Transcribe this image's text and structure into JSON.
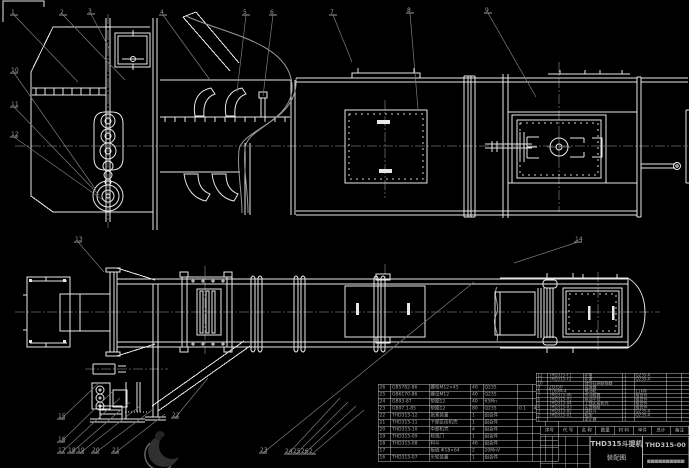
{
  "colors": {
    "background": "#000000",
    "drawing_line": "#e8e8e8",
    "leader_line": "#7d7d7d",
    "table_line": "#c4c4c4",
    "table_text": "#a8a8a8"
  },
  "title_block": {
    "product": "THD315斗提机",
    "subtitle": "装配图",
    "drawing_no": "THD315-00",
    "footer": "■■■■■■■■■■"
  },
  "bom": {
    "header": [
      "序号",
      "代  号",
      "名  称",
      "数量",
      "材  料",
      "单件",
      "总计",
      "备注"
    ],
    "left": {
      "rows": [
        [
          "26",
          "GB5782-86",
          "螺栓M12×45",
          "40",
          "Q235",
          "",
          "",
          ""
        ],
        [
          "25",
          "GB6170-86",
          "螺母M12",
          "40",
          "Q235",
          "",
          "",
          ""
        ],
        [
          "24",
          "GB93-87",
          "垫圈12",
          "40",
          "65Mn",
          "",
          "",
          ""
        ],
        [
          "23",
          "GB97.1-85",
          "垫圈12",
          "80",
          "Q235",
          "0.1",
          "4",
          ""
        ],
        [
          "22",
          "THD315-12",
          "张紧装置",
          "1",
          "组合件",
          "",
          "",
          ""
        ],
        [
          "21",
          "THD315-11",
          "下部区段机壳",
          "1",
          "组合件",
          "",
          "",
          ""
        ],
        [
          "20",
          "THD315-10",
          "中部机壳",
          "4",
          "组合件",
          "",
          "",
          ""
        ],
        [
          "19",
          "THD315-09",
          "检视门",
          "1",
          "组合件",
          "",
          "",
          ""
        ],
        [
          "18",
          "THD315-08",
          "料斗",
          "46",
          "组合件",
          "",
          "",
          ""
        ],
        [
          "17",
          "",
          "板链 Φ18×64",
          "2",
          "20MnV",
          "",
          "",
          ""
        ],
        [
          "16",
          "THD315-07",
          "头轮装置",
          "1",
          "组合件",
          "",
          "",
          ""
        ]
      ]
    },
    "right": {
      "rows": [
        [
          "12",
          "THD315-F1",
          "护罩",
          "1",
          "Q235-A",
          "",
          "",
          ""
        ],
        [
          "11",
          "THD315-F2",
          "护罩",
          "1",
          "Q235-A",
          "",
          "",
          ""
        ],
        [
          "10",
          "",
          "弹性柱销联轴器",
          "1",
          "",
          "",
          "",
          ""
        ],
        [
          "9",
          "ZQ350",
          "减速器",
          "1",
          "",
          "",
          "",
          ""
        ],
        [
          "8",
          "Y160M-4",
          "电动机",
          "1",
          "11kW",
          "",
          "",
          ""
        ],
        [
          "7",
          "THD315-06",
          "传动装置",
          "1",
          "组合件",
          "",
          "",
          ""
        ],
        [
          "6",
          "THD315-05",
          "驱动平台",
          "1",
          "组合件",
          "",
          "",
          ""
        ],
        [
          "5",
          "THD315-04",
          "上部区段机壳",
          "1",
          "组合件",
          "",
          "",
          ""
        ],
        [
          "4",
          "THD315-03",
          "头部轴组",
          "1",
          "组合件",
          "",
          "",
          ""
        ],
        [
          "3",
          "THD315-02",
          "进料斗",
          "1",
          "Q235-A",
          "",
          "",
          ""
        ],
        [
          "2",
          "THD315-01",
          "机架",
          "1",
          "Q235-A",
          "",
          "",
          ""
        ],
        [
          "1",
          "",
          "逆止器",
          "1",
          "",
          "",
          "",
          ""
        ]
      ]
    }
  },
  "callouts": [
    {
      "n": "1",
      "x": 11,
      "y": 8,
      "tx": 78,
      "ty": 82
    },
    {
      "n": "2",
      "x": 60,
      "y": 8,
      "tx": 125,
      "ty": 80
    },
    {
      "n": "3",
      "x": 88,
      "y": 7,
      "tx": 109,
      "ty": 48
    },
    {
      "n": "4",
      "x": 160,
      "y": 8,
      "tx": 210,
      "ty": 80
    },
    {
      "n": "5",
      "x": 243,
      "y": 8,
      "tx": 237,
      "ty": 92
    },
    {
      "n": "6",
      "x": 270,
      "y": 8,
      "tx": 263,
      "ty": 96
    },
    {
      "n": "7",
      "x": 330,
      "y": 8,
      "tx": 352,
      "ty": 62
    },
    {
      "n": "8",
      "x": 407,
      "y": 6,
      "tx": 418,
      "ty": 109
    },
    {
      "n": "9",
      "x": 485,
      "y": 6,
      "tx": 536,
      "ty": 97
    },
    {
      "n": "10",
      "x": 11,
      "y": 66,
      "tx": 96,
      "ty": 190
    },
    {
      "n": "11",
      "x": 11,
      "y": 100,
      "tx": 99,
      "ty": 195
    },
    {
      "n": "12",
      "x": 11,
      "y": 130,
      "tx": 103,
      "ty": 200
    },
    {
      "n": "13",
      "x": 75,
      "y": 235,
      "tx": 104,
      "ty": 272
    },
    {
      "n": "14",
      "x": 575,
      "y": 235,
      "tx": 514,
      "ty": 263
    },
    {
      "n": "15",
      "x": 58,
      "y": 412,
      "tx": 100,
      "ty": 382
    },
    {
      "n": "16",
      "x": 58,
      "y": 435,
      "tx": 112,
      "ty": 392
    },
    {
      "n": "17",
      "x": 58,
      "y": 446,
      "tx": 120,
      "ty": 398
    },
    {
      "n": "18",
      "x": 68,
      "y": 446,
      "tx": 130,
      "ty": 402
    },
    {
      "n": "19",
      "x": 77,
      "y": 446,
      "tx": 140,
      "ty": 406
    },
    {
      "n": "20",
      "x": 92,
      "y": 446,
      "tx": 152,
      "ty": 410
    },
    {
      "n": "21",
      "x": 112,
      "y": 446,
      "tx": 165,
      "ty": 414
    },
    {
      "n": "22",
      "x": 172,
      "y": 411,
      "tx": 208,
      "ty": 378
    },
    {
      "n": "23",
      "x": 260,
      "y": 446,
      "tx": 474,
      "ty": 282
    },
    {
      "n": "24",
      "x": 285,
      "y": 447,
      "tx": 340,
      "ty": 398
    },
    {
      "n": "25",
      "x": 293,
      "y": 447,
      "tx": 348,
      "ty": 402
    },
    {
      "n": "26",
      "x": 301,
      "y": 447,
      "tx": 356,
      "ty": 406
    },
    {
      "n": "2",
      "x": 309,
      "y": 447,
      "tx": 364,
      "ty": 410
    }
  ]
}
